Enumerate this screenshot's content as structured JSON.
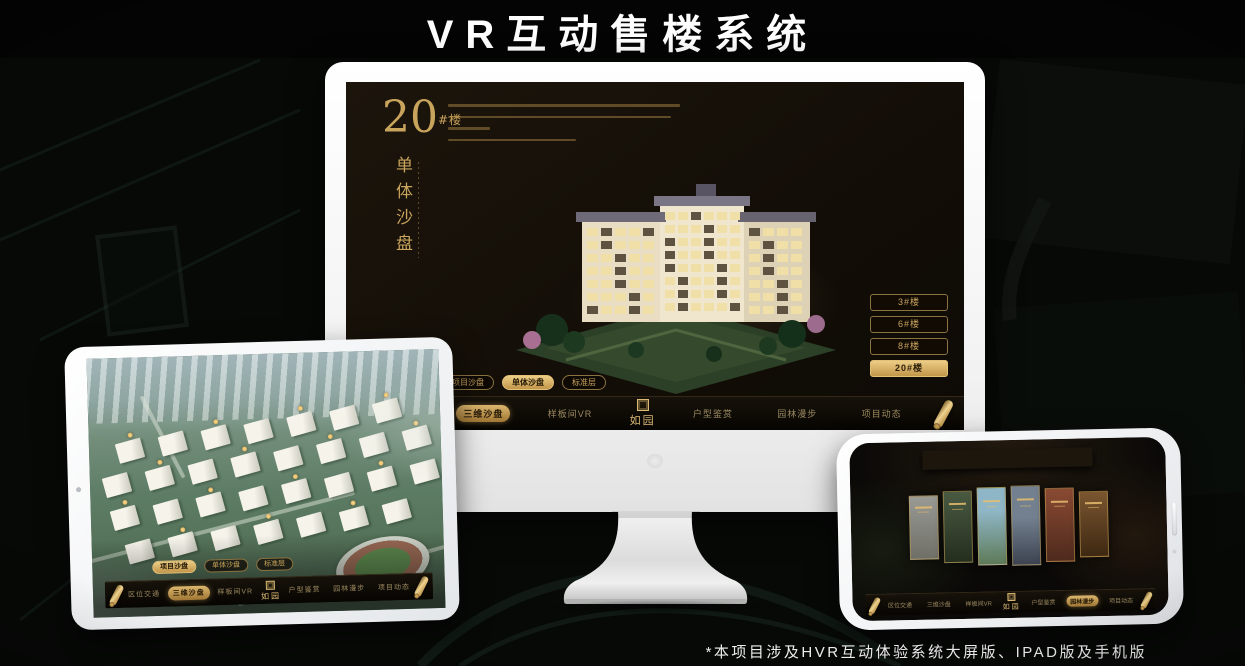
{
  "title": "VR互动售楼系统",
  "footnote": "*本项目涉及HVR互动体验系统大屏版、IPAD版及手机版",
  "brand": {
    "logo": "如园"
  },
  "nav": {
    "items": [
      "区位交通",
      "三维沙盘",
      "样板间VR",
      "户型鉴赏",
      "园林漫步",
      "项目动态"
    ]
  },
  "sub_tabs": [
    "项目沙盘",
    "单体沙盘",
    "标准层"
  ],
  "monitor": {
    "floor_no": "20",
    "floor_unit": "#楼",
    "heading": "单体沙盘",
    "building_buttons": [
      "3#楼",
      "6#楼",
      "8#楼",
      "20#楼"
    ],
    "active_building": "20#楼",
    "active_nav": "三维沙盘",
    "active_sub_tab": "单体沙盘"
  },
  "tablet": {
    "active_nav": "三维沙盘",
    "active_sub_tab": "项目沙盘"
  },
  "phone": {
    "active_nav": "园林漫步"
  },
  "colors": {
    "gold": "#c9a45c",
    "gold_bright": "#e8c87e",
    "screen_bg": "#171109",
    "text_light": "#f2f2f2"
  }
}
